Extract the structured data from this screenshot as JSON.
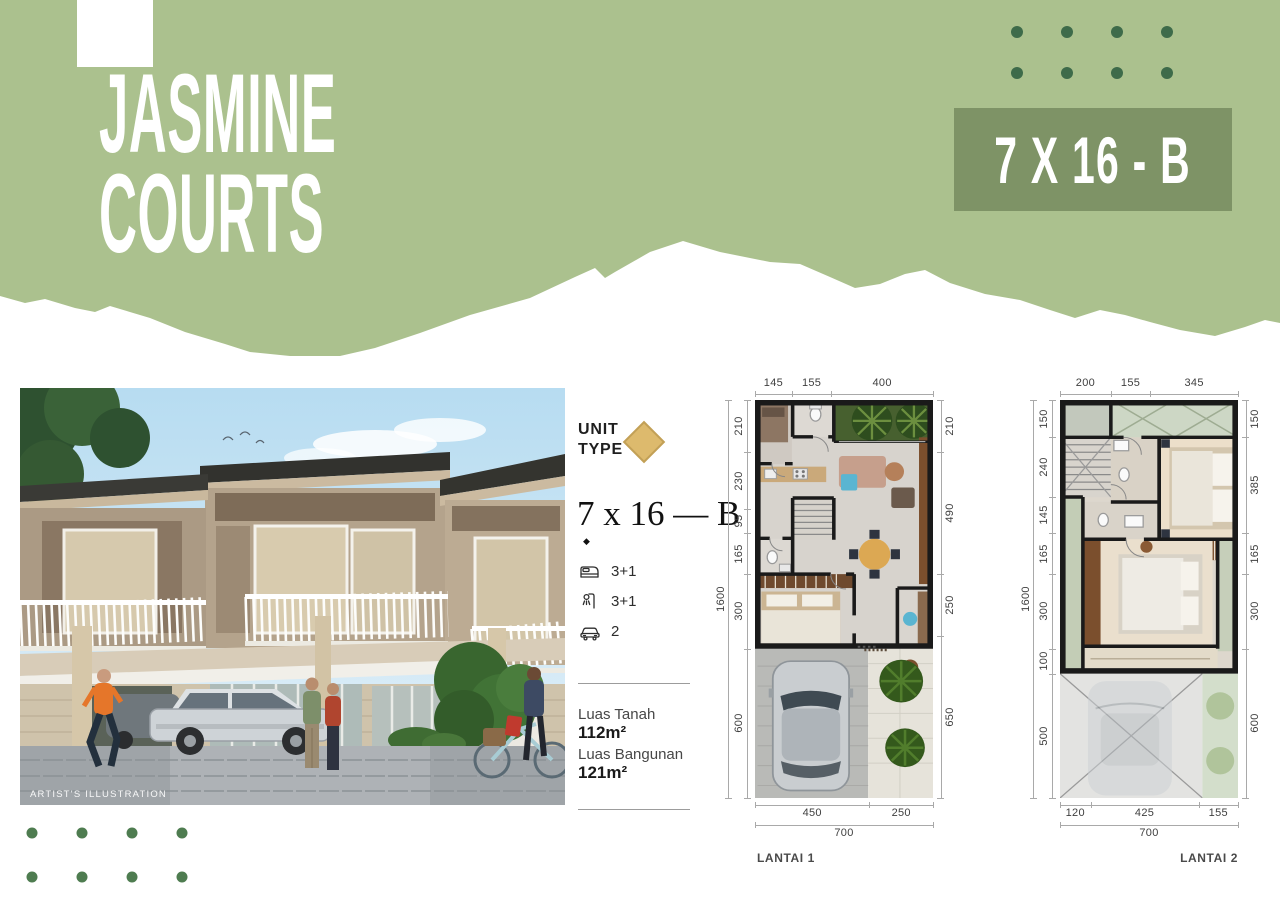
{
  "header": {
    "title_line1": "JASMINE",
    "title_line2": "COURTS",
    "badge_label": "7 X 16 - B",
    "colors": {
      "band": "#abc18e",
      "badge_bg": "#7e9366",
      "dots_top": "#3e6b4a",
      "dots_bottom": "#4e7c50",
      "title_text": "#ffffff"
    }
  },
  "photo": {
    "caption": "ARTIST'S ILLUSTRATION"
  },
  "unit_info": {
    "unit_type_line1": "UNIT",
    "unit_type_line2": "TYPE",
    "diamond_color": "#ddba6d",
    "type_name": "7 x 16 — B",
    "bullet": "◆",
    "features": [
      {
        "icon": "bed-icon",
        "value": "3+1"
      },
      {
        "icon": "shower-icon",
        "value": "3+1"
      },
      {
        "icon": "car-icon",
        "value": "2"
      }
    ],
    "land": {
      "label": "Luas Tanah",
      "value": "112m²"
    },
    "building": {
      "label": "Luas Bangunan",
      "value": "121m²"
    }
  },
  "floorplans": [
    {
      "label": "LANTAI 1",
      "dims": {
        "top": [
          145,
          155,
          400
        ],
        "left": [
          210,
          230,
          95,
          165,
          300,
          600
        ],
        "left_total": 1600,
        "right": [
          210,
          490,
          250,
          650
        ],
        "bottom": [
          450,
          250
        ],
        "bottom_total": 700
      }
    },
    {
      "label": "LANTAI 2",
      "dims": {
        "top": [
          200,
          155,
          345
        ],
        "left": [
          150,
          240,
          145,
          165,
          300,
          100,
          500
        ],
        "left_total": 1600,
        "right": [
          150,
          385,
          165,
          300,
          600
        ],
        "bottom": [
          120,
          425,
          155
        ],
        "bottom_total": 700
      }
    }
  ]
}
